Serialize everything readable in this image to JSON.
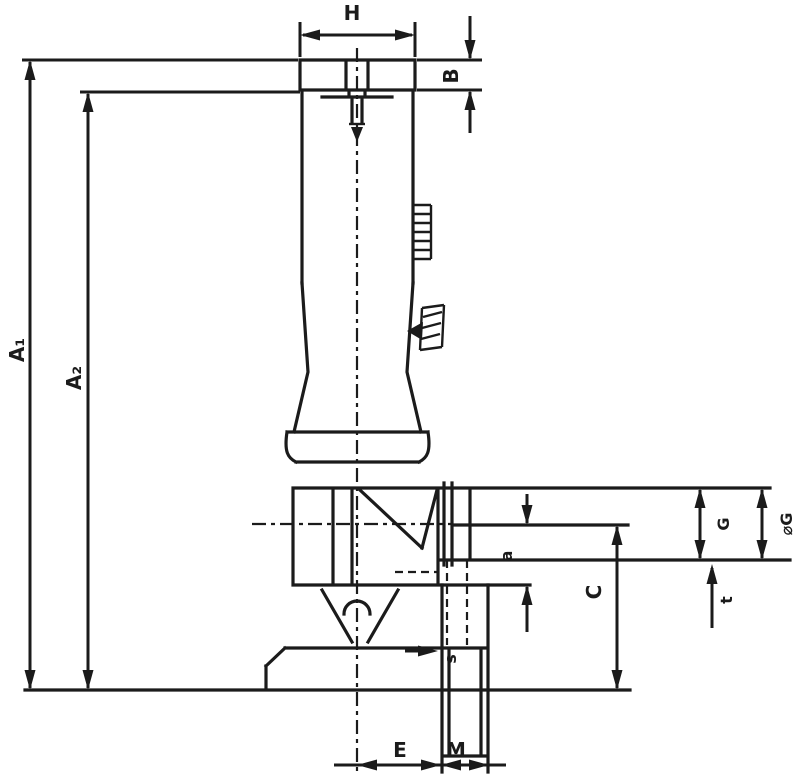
{
  "page": {
    "background": "#ffffff",
    "line_color": "#1b1b1b",
    "type": "technical-dimension-drawing"
  },
  "labels": {
    "h": "H",
    "b": "B",
    "a1": "A₁",
    "a2": "A₂",
    "g": "G",
    "phi_g": "⌀G",
    "t": "t",
    "a_small": "a",
    "c": "C",
    "s": "s",
    "e": "E",
    "m": "M"
  }
}
